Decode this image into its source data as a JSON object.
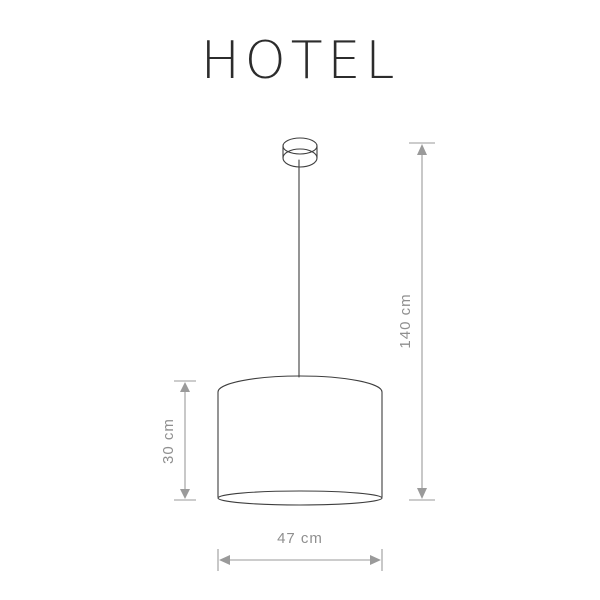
{
  "title": "HOTEL",
  "dimensions": {
    "overall_height": "140 cm",
    "shade_height": "30 cm",
    "shade_diameter": "47 cm"
  },
  "colors": {
    "background": "#ffffff",
    "outline": "#3e3e3e",
    "dimension": "#9a9a9a",
    "dimension_text": "#8f8f8f",
    "title_text": "#2c2c2c"
  }
}
